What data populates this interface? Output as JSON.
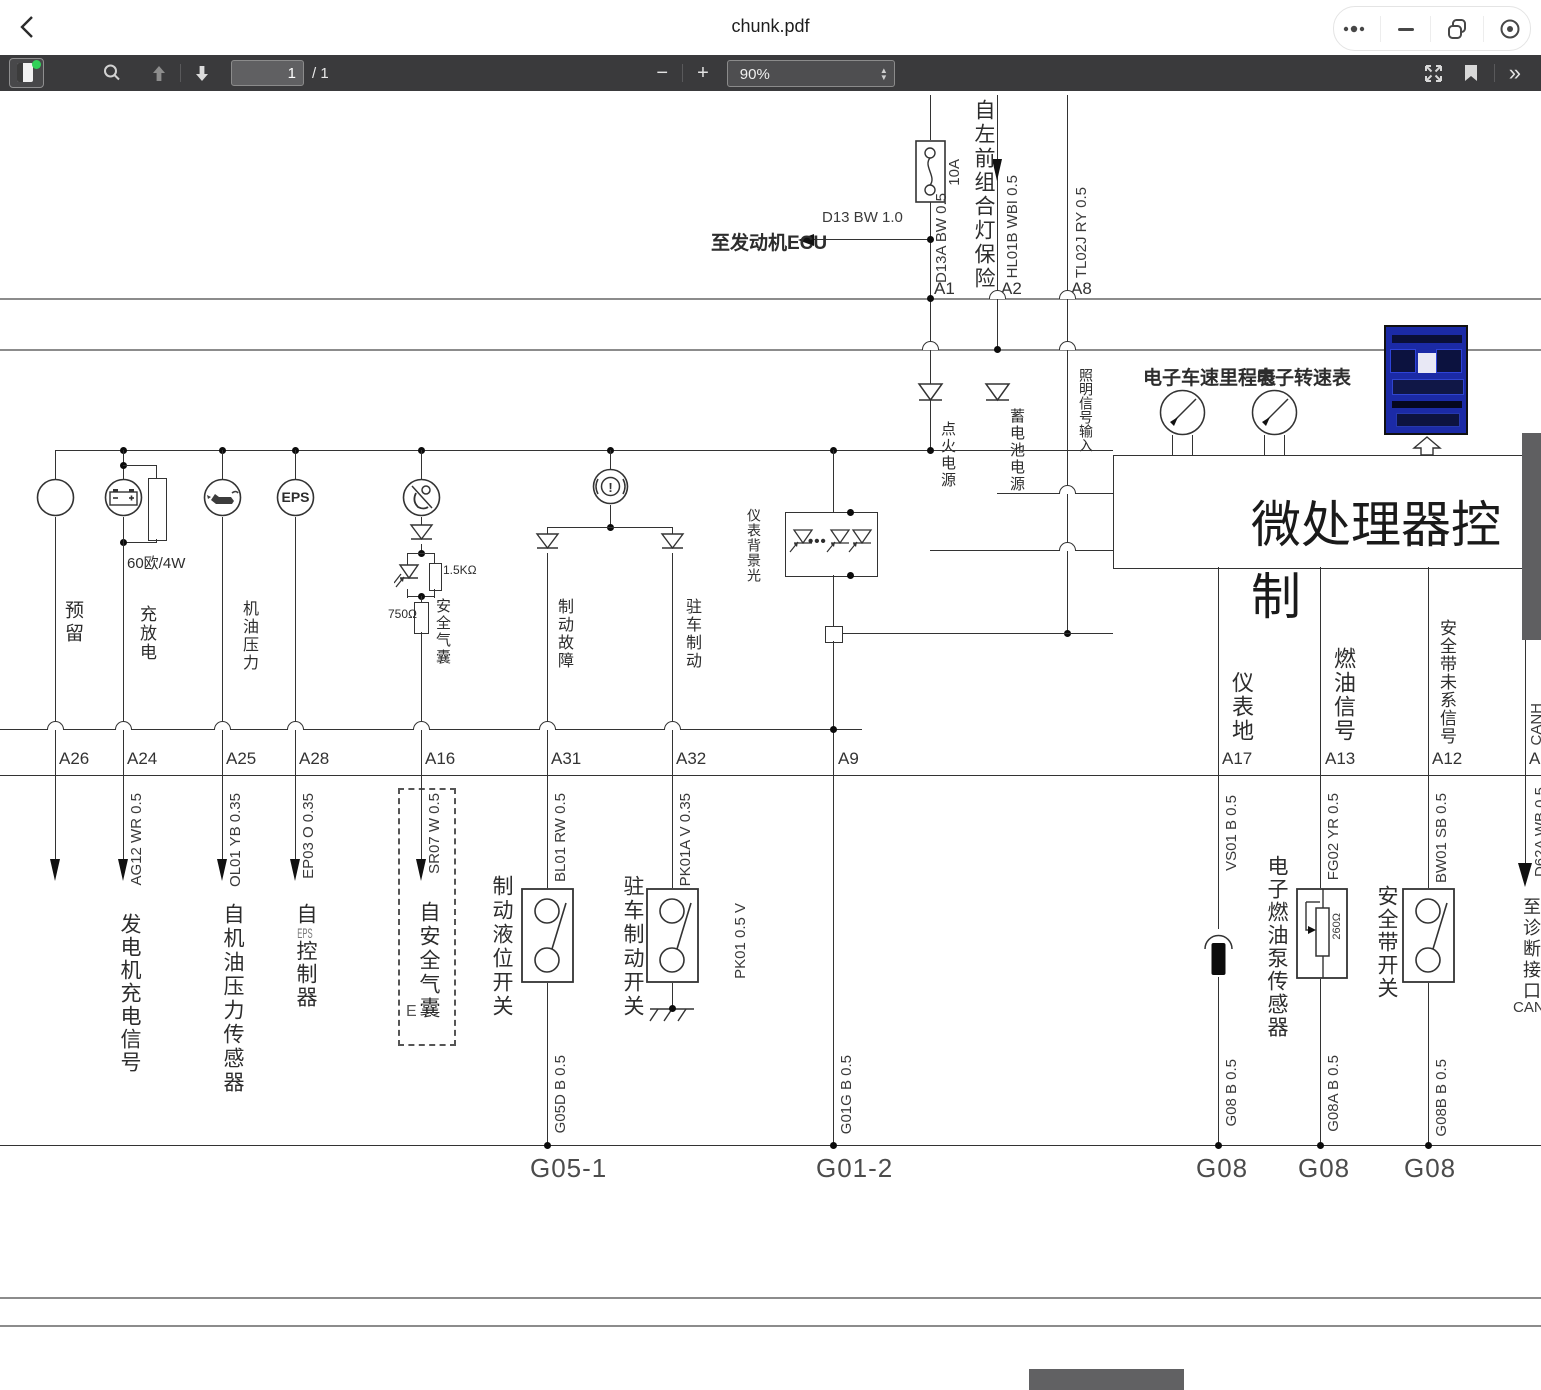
{
  "colors": {
    "toolbar_bg": "#3a3a3c",
    "page_bg": "#ffffff",
    "line": "#333333",
    "rail": "#8c8c8c",
    "scroll_thumb": "#5f5f61",
    "green_dot": "#31d158",
    "blue_image_bg": "#1b2aa6"
  },
  "titlebar": {
    "title": "chunk.pdf"
  },
  "toolbar": {
    "page_value": "1",
    "page_total": "/ 1",
    "zoom_out": "−",
    "zoom_in": "+",
    "zoom_value": "90%",
    "more": "»"
  },
  "top": {
    "ecu": "至发动机ECU",
    "d13": "D13 BW 1.0",
    "d13a": "D13A BW 0.5",
    "fuse": "10A",
    "lamp_fuse": "自左前组合灯保险",
    "hl01b": "HL01B WBI 0.5",
    "tl02j": "TL02J RY 0.5",
    "a1": "A1",
    "a2": "A2",
    "a8": "A8",
    "illum": "照明信号输入",
    "ign": "点火电源",
    "batt": "蓄电池电源"
  },
  "mcu": {
    "label": "微处理器控制",
    "speedo": "电子车速里程表",
    "tacho": "电子转速表"
  },
  "lamps": {
    "reserved": "预留",
    "charge": "充放电",
    "r60": "60欧/4W",
    "oil": "机油压力",
    "eps": "EPS",
    "airbag": "安全气囊",
    "r15k": "1.5KΩ",
    "r750": "750Ω",
    "brake_fault": "制动故障",
    "parking": "驻车制动",
    "backlight": "仪表背景光"
  },
  "pins": {
    "a26": "A26",
    "a24": "A24",
    "a25": "A25",
    "a28": "A28",
    "a16": "A16",
    "a31": "A31",
    "a32": "A32",
    "a9": "A9",
    "a17": "A17",
    "a13": "A13",
    "a12": "A12",
    "a1": "A1"
  },
  "wires": {
    "ag12": "AG12 WR 0.5",
    "ol01": "OL01 YB 0.35",
    "ep03": "EP03 O 0.35",
    "sr07": "SR07 W 0.5",
    "bl01": "BL01 RW 0.5",
    "pk01a": "PK01A V 0.35",
    "pk01": "PK01 0.5 V",
    "vs01": "VS01 B 0.5",
    "fg02": "FG02 YR 0.5",
    "bw01": "BW01 SB 0.5",
    "g05d": "G05D B 0.5",
    "g01g": "G01G B 0.5",
    "g08": "G08 B 0.5",
    "g08a": "G08A B 0.5",
    "g08b": "G08B B 0.5",
    "d62a": "D62A WB 0.5",
    "canh": "CANH",
    "canl": "CANL"
  },
  "components": {
    "gen_signal": "发电机充电信号",
    "oil_sensor": "自机油压力传感器",
    "eps_prefix": "自",
    "eps_mid": "EPS",
    "eps_suffix": "控制器",
    "airbag_box": "自安全气囊",
    "airbag_e": "E",
    "brake_level": "制动液位开关",
    "parking_switch": "驻车制动开关",
    "fuel_sensor": "电子燃油泵传感器",
    "r260": "260Ω",
    "seatbelt": "安全带开关",
    "diag": "至诊断接口",
    "meter_gnd": "仪表地",
    "fuel_signal": "燃油信号",
    "seatbelt_signal": "安全带未系信号"
  },
  "grounds": {
    "g05_1": "G05-1",
    "g01_2": "G01-2",
    "g08_a": "G08",
    "g08_b": "G08",
    "g08_c": "G08"
  }
}
